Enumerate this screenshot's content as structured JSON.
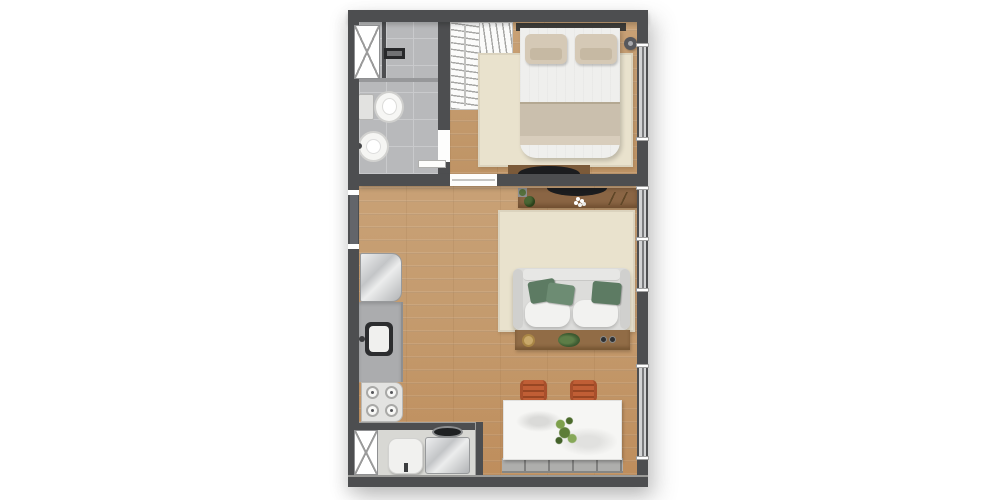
{
  "image_type": "architectural-floor-plan-top-view",
  "visible_text": [],
  "palette": {
    "background": "#ffffff",
    "wall": "#4d4e50",
    "wood-floor": "#c59b6d",
    "tile-floor": "#b8b9bb",
    "rug": "#e9e2cd",
    "closet": "#fbfbfa",
    "sideboard-wood": "#8a6544",
    "console-wood": "#916c46",
    "tv-black": "#1c1d1f",
    "sofa-body": "#dcdcda",
    "sofa-cushion": "#f2f2f0",
    "pillow-green": "#5d7b63",
    "pillow-beige": "#d5c9b6",
    "bed-blanket": "#cabfad",
    "marble-table": "#f6f6f4",
    "chair-orange": "#c05e35",
    "bench-gray": "#a3a3a1",
    "counter-gray": "#abacae",
    "stainless-light": "#edeeef",
    "stainless-dark": "#b2b4b6",
    "window-glass": "#d2d3d4",
    "headboard-dark": "#3e3c38"
  },
  "rooms": [
    {
      "name": "bathroom",
      "position": "top-left",
      "floor": "gray-tile",
      "items": [
        "casement-window",
        "shower-area",
        "linear-drain",
        "glass-partition",
        "toilet",
        "round-washbasin",
        "door-to-hall"
      ]
    },
    {
      "name": "bedroom",
      "position": "top-right",
      "floor": "wood",
      "items": [
        "l-shaped-wardrobe-with-hangers",
        "double-bed",
        "2-beige-pillows",
        "dark-headboard",
        "beige-area-rug",
        "corner-table-lamp",
        "tv-on-low-unit",
        "window"
      ]
    },
    {
      "name": "living-room",
      "position": "center",
      "floor": "wood",
      "items": [
        "entry-door",
        "tv-sideboard-with-plants",
        "white-flower-decor",
        "sofa-with-3-green-cushions",
        "console-table-with-tray-plant-coasters",
        "beige-area-rug",
        "2-windows"
      ]
    },
    {
      "name": "kitchen",
      "position": "center-left-wall",
      "floor": "wood",
      "items": [
        "refrigerator",
        "countertop-with-sink-and-faucet",
        "cooktop-4-burners"
      ]
    },
    {
      "name": "laundry-service",
      "position": "bottom-left",
      "floor": "light-gray",
      "items": [
        "casement-window",
        "water-heater",
        "top-load-washing-machine"
      ]
    },
    {
      "name": "dining",
      "position": "bottom-right",
      "floor": "wood",
      "items": [
        "white-marble-table",
        "plant-centerpiece",
        "2-orange-chairs",
        "gray-upholstered-bench",
        "window"
      ]
    }
  ],
  "counts": {
    "stove_burners": 4,
    "sofa_green_pillows": 3,
    "dining_chairs": 2,
    "bench_segments": 5,
    "right_wall_windows": 3,
    "x_windows": 2
  }
}
